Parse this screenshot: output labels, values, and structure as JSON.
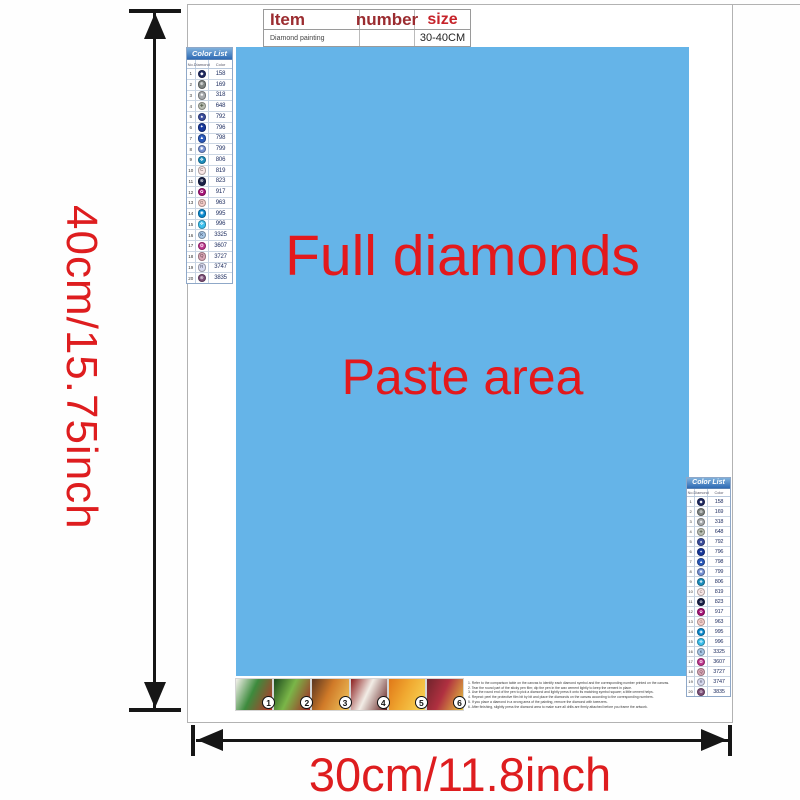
{
  "item_table": {
    "headers": [
      "Item",
      "number",
      "size"
    ],
    "row": {
      "item": "Diamond painting",
      "number": "",
      "size": "30-40CM"
    }
  },
  "paste_area": {
    "line1": "Full diamonds",
    "line2": "Paste area",
    "bg": "#65b4e8",
    "text_color": "#e3191c"
  },
  "color_list": {
    "title": "Color List",
    "columns": [
      "No.",
      "Diamond",
      "Color"
    ],
    "rows": [
      {
        "no": "1",
        "symbol": "◆",
        "code": "158",
        "bg": "#1f2a63",
        "fg": "#ffffff"
      },
      {
        "no": "2",
        "symbol": "⊕",
        "code": "169",
        "bg": "#7f8583",
        "fg": "#ffffff"
      },
      {
        "no": "3",
        "symbol": "♣",
        "code": "318",
        "bg": "#a5a9ac",
        "fg": "#ffffff"
      },
      {
        "no": "4",
        "symbol": "✚",
        "code": "648",
        "bg": "#b9beb3",
        "fg": "#55604f"
      },
      {
        "no": "5",
        "symbol": "♠",
        "code": "792",
        "bg": "#3b4e9e",
        "fg": "#ffffff"
      },
      {
        "no": "6",
        "symbol": "✦",
        "code": "796",
        "bg": "#17389c",
        "fg": "#ffffff"
      },
      {
        "no": "7",
        "symbol": "▲",
        "code": "798",
        "bg": "#2a5abc",
        "fg": "#ffffff"
      },
      {
        "no": "8",
        "symbol": "✱",
        "code": "799",
        "bg": "#7490d4",
        "fg": "#ffffff"
      },
      {
        "no": "9",
        "symbol": "❖",
        "code": "806",
        "bg": "#1d90c0",
        "fg": "#ffffff"
      },
      {
        "no": "10",
        "symbol": "C",
        "code": "819",
        "bg": "#f8e6e6",
        "fg": "#6a5a5a"
      },
      {
        "no": "11",
        "symbol": "⊗",
        "code": "823",
        "bg": "#182048",
        "fg": "#ffffff"
      },
      {
        "no": "12",
        "symbol": "✿",
        "code": "917",
        "bg": "#a81479",
        "fg": "#ffffff"
      },
      {
        "no": "13",
        "symbol": "G",
        "code": "963",
        "bg": "#f6cdc9",
        "fg": "#6a5a5a"
      },
      {
        "no": "14",
        "symbol": "◉",
        "code": "995",
        "bg": "#0b8ad0",
        "fg": "#ffffff"
      },
      {
        "no": "15",
        "symbol": "✜",
        "code": "996",
        "bg": "#3cc0ee",
        "fg": "#ffffff"
      },
      {
        "no": "16",
        "symbol": "K",
        "code": "3325",
        "bg": "#a6c6e6",
        "fg": "#2c3a50"
      },
      {
        "no": "17",
        "symbol": "❂",
        "code": "3607",
        "bg": "#c0368f",
        "fg": "#ffffff"
      },
      {
        "no": "18",
        "symbol": "Q",
        "code": "3727",
        "bg": "#d9a6b6",
        "fg": "#5c3a46"
      },
      {
        "no": "19",
        "symbol": "R",
        "code": "3747",
        "bg": "#d7daf0",
        "fg": "#4a4e66"
      },
      {
        "no": "20",
        "symbol": "⊛",
        "code": "3835",
        "bg": "#7e4f7a",
        "fg": "#ffffff"
      }
    ]
  },
  "dimensions": {
    "height_label": "40cm/15.75inch",
    "width_label": "30cm/11.8inch",
    "label_color": "#de1d1f",
    "arrow_color": "#161616"
  },
  "steps": [
    {
      "num": "1",
      "colors": [
        "#f5f2ec",
        "#3d8b3d",
        "#c03028"
      ]
    },
    {
      "num": "2",
      "colors": [
        "#1c4a1e",
        "#7ab648",
        "#a42423"
      ]
    },
    {
      "num": "3",
      "colors": [
        "#5a3620",
        "#d07a28",
        "#f0c75e"
      ]
    },
    {
      "num": "4",
      "colors": [
        "#8c1f1f",
        "#f2ede6",
        "#5f1a1a"
      ]
    },
    {
      "num": "5",
      "colors": [
        "#e07818",
        "#f0a830",
        "#f8d858"
      ]
    },
    {
      "num": "6",
      "colors": [
        "#70242c",
        "#b03040",
        "#e8c840"
      ]
    }
  ],
  "instructions": [
    "1. Refer to the comparison table on the canvas to identify each diamond symbol and the corresponding number printed on the canvas.",
    "2. Tear the round part of the sticky pen film; dip the pen in the wax cement lightly to keep the cement in place.",
    "3. Use the round end of the pen to pick a diamond and lightly press it onto its matching symbol square; a little cement helps.",
    "4. Repeat: peel the protective film bit by bit and place the diamonds on the canvas according to the corresponding numbers.",
    "5. If you place a diamond in a wrong area of the painting, remove the diamond with tweezers.",
    "6. After finishing, slightly press the diamond area to make sure all drills are firmly attached before you frame the artwork."
  ]
}
